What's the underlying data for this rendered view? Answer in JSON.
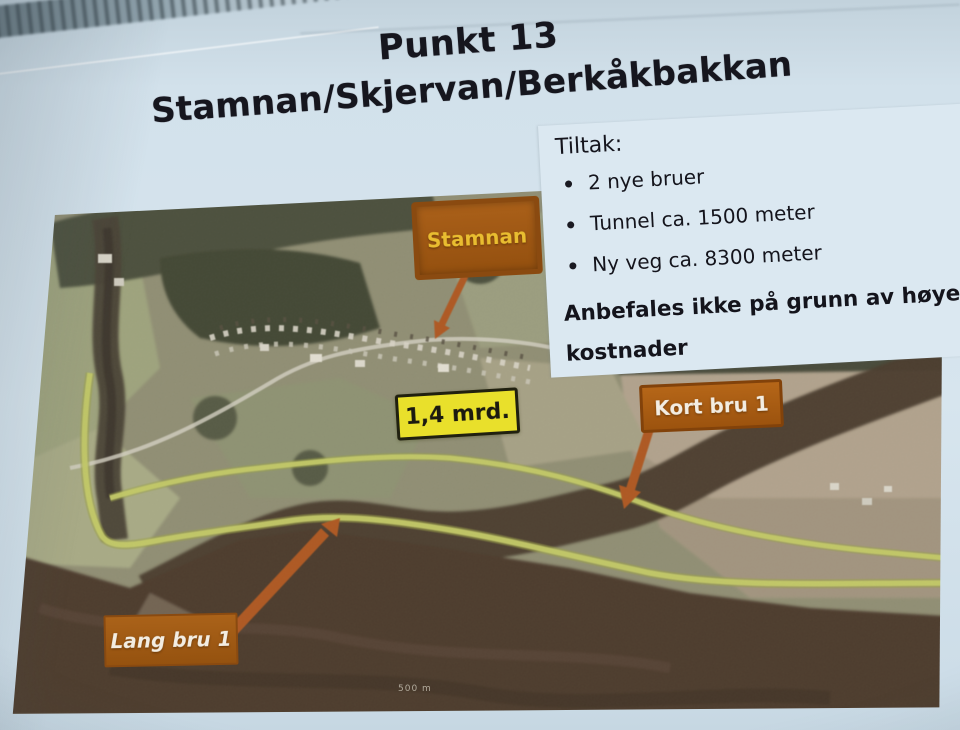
{
  "slide": {
    "title": {
      "line1": "Punkt 13",
      "line2": "Stamnan/Skjervan/Berkåkbakkan"
    },
    "measures": {
      "heading": "Tiltak:",
      "bullets": [
        "2 nye bruer",
        "Tunnel ca. 1500 meter",
        "Ny veg ca. 8300 meter"
      ],
      "recommendation": "Anbefales ikke på grunn av høye kostnader"
    },
    "map": {
      "type": "aerial-photo",
      "labels": {
        "village": "Stamnan",
        "cost": "1,4 mrd.",
        "short_bridge": "Kort bru 1",
        "long_bridge": "Lang bru 1",
        "scale": "500 m"
      }
    },
    "colors": {
      "slide_background": "#d7e5ee",
      "label_box_orange": "#a95f16",
      "label_text_yellow": "#e9bd30",
      "cost_box_yellow": "#e9e02b",
      "route_highlight": "#c3ca5f",
      "title_text": "#16161e"
    }
  }
}
